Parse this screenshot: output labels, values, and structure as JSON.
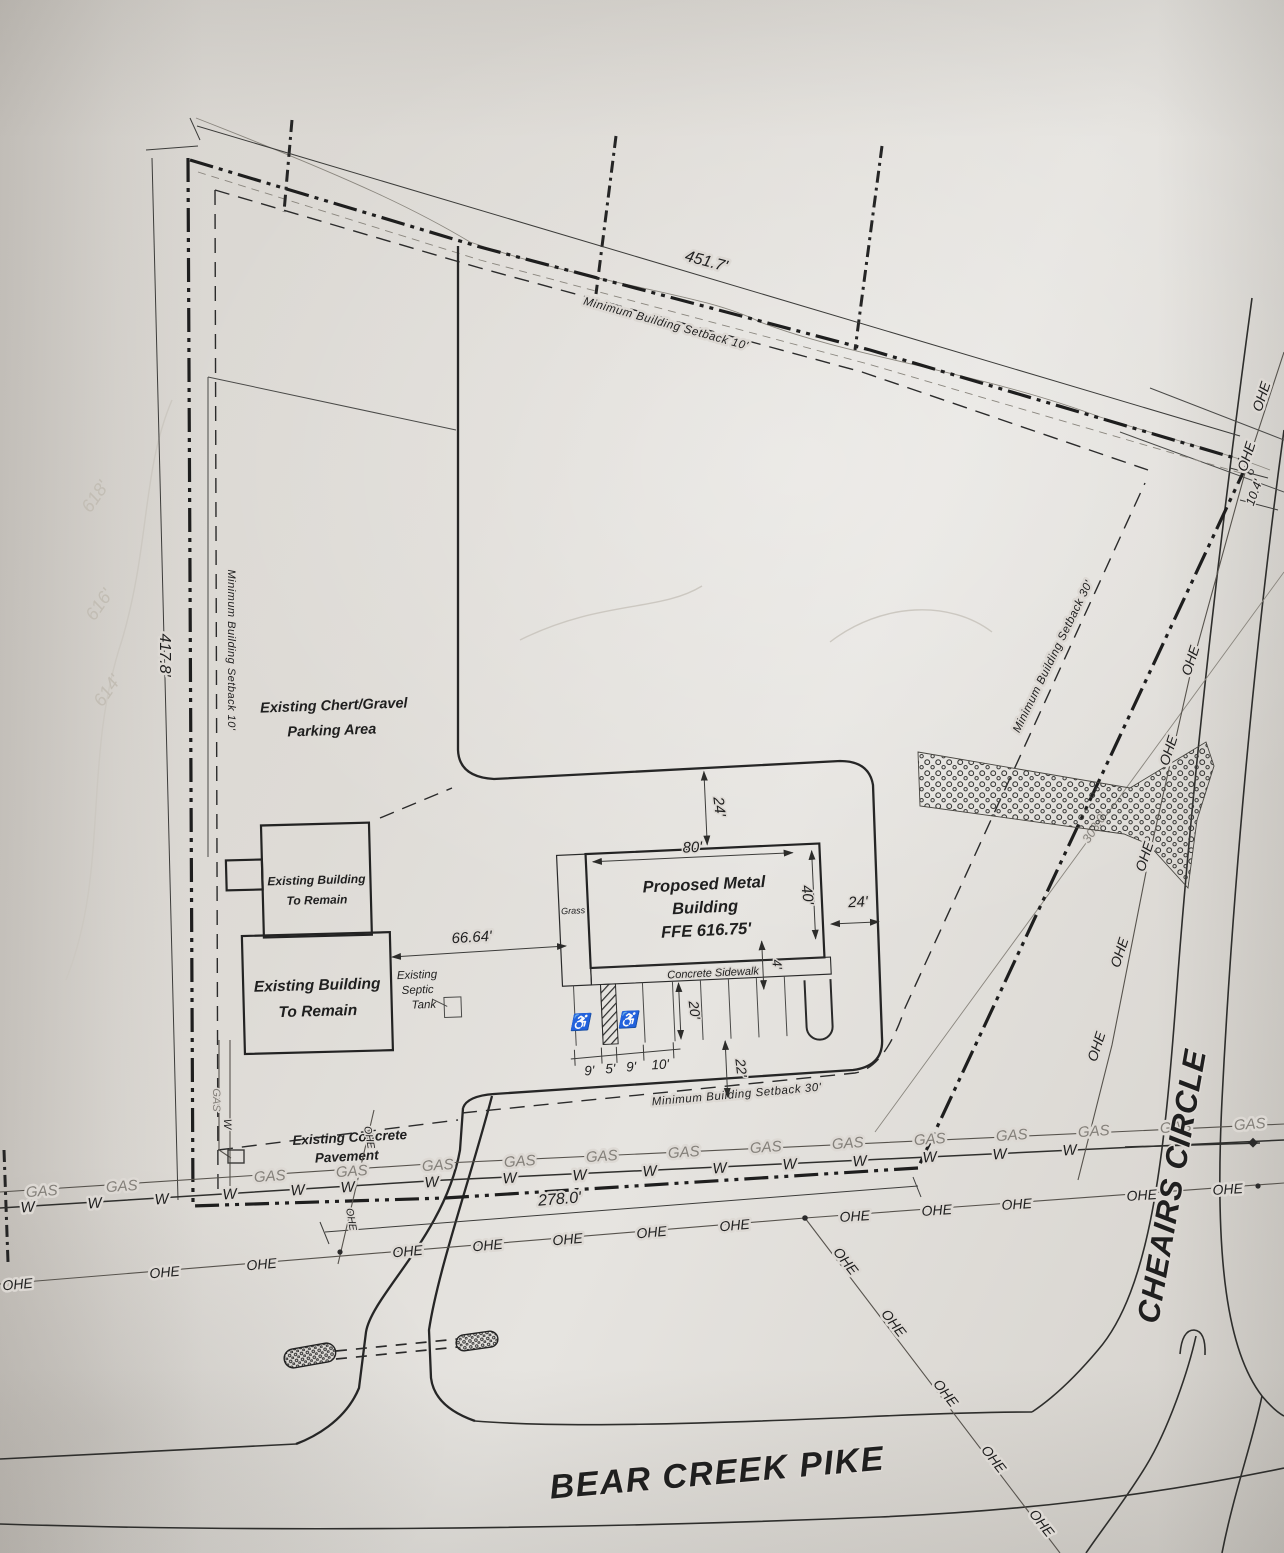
{
  "roads": {
    "bear_creek_pike": "BEAR CREEK PIKE",
    "cheairs_circle": "CHEAIRS CIRCLE"
  },
  "areas": {
    "chert_line1": "Existing Chert/Gravel",
    "chert_line2": "Parking Area",
    "bldg_line1": "Existing Building",
    "bldg_line2": "To Remain",
    "concrete_line1": "Existing Concrete",
    "concrete_line2": "Pavement",
    "proposed_line1": "Proposed Metal",
    "proposed_line2": "Building",
    "proposed_line3": "FFE 616.75'",
    "septic_line1": "Existing",
    "septic_line2": "Septic",
    "septic_line3": "Tank",
    "sidewalk": "Concrete Sidewalk",
    "grass": "Grass"
  },
  "setbacks": {
    "ten": "Minimum Building Setback 10'",
    "thirty": "Minimum Building Setback 30'"
  },
  "dimensions": {
    "north": "451.7'",
    "west": "417.8'",
    "south": "278.0'",
    "gap": "66.64'",
    "bldg_w": "80'",
    "bldg_d": "40'",
    "drive_n": "24'",
    "drive_e": "24'",
    "stall_9a": "9'",
    "stall_5": "5'",
    "stall_9b": "9'",
    "stall_10": "10'",
    "stall_depth": "20'",
    "aisle": "22'",
    "walk": "4'",
    "jog": "10.4'",
    "row": "303.0'"
  },
  "utilities": {
    "gas": "GAS",
    "water": "W",
    "ohe": "OHE"
  },
  "symbols": {
    "accessible": "♿"
  },
  "ghost": {
    "c618": "618'",
    "c616": "616'",
    "c614": "614'"
  },
  "colors": {
    "paper": "#dcd9d4",
    "ink": "#1f1f1f",
    "gray_ink": "#84807a",
    "ghost": "#c2bdb4"
  }
}
